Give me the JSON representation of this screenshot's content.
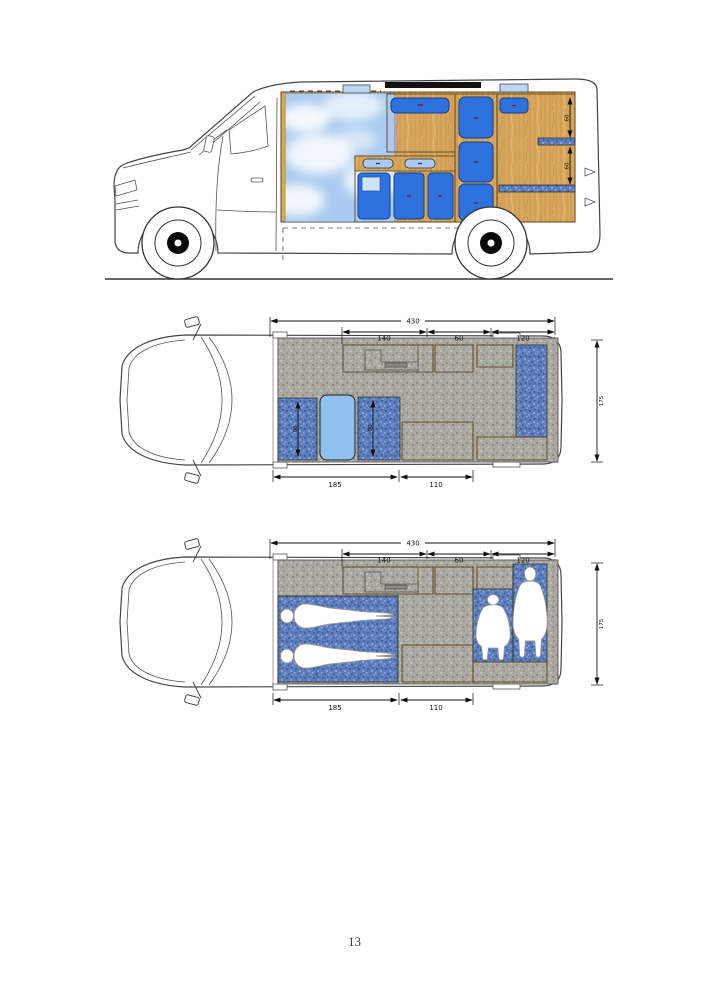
{
  "page": {
    "number": "13"
  },
  "figures": {
    "side": {
      "name": "camper-van side elevation with interior units",
      "dim_upper_shelf": "60",
      "dim_lower_shelf": "60"
    },
    "plan_day": {
      "name": "camper-van floor plan, travelling layout",
      "dim_overall": "430",
      "dim_galley": "140",
      "dim_mid": "60",
      "dim_rear": "120",
      "dim_bed": "185",
      "dim_kitchen": "110",
      "dim_width": "175",
      "dim_seat_left": "90",
      "dim_seat_right": "90"
    },
    "plan_night": {
      "name": "camper-van floor plan, sleeping layout with occupants",
      "dim_overall": "430",
      "dim_galley": "140",
      "dim_mid": "60",
      "dim_rear": "120",
      "dim_bed": "185",
      "dim_kitchen": "110",
      "dim_width": "175"
    }
  },
  "colors": {
    "door_blue": "#2e72df",
    "light_blue": "#bcd7f2",
    "table_blue": "#8fc1f0",
    "wood": "#d8a75e",
    "upholstery_denim": "#5d7ebc",
    "floor_grey": "#aaa8a0",
    "sky": "#a9cbf0",
    "linework": "#454545"
  }
}
